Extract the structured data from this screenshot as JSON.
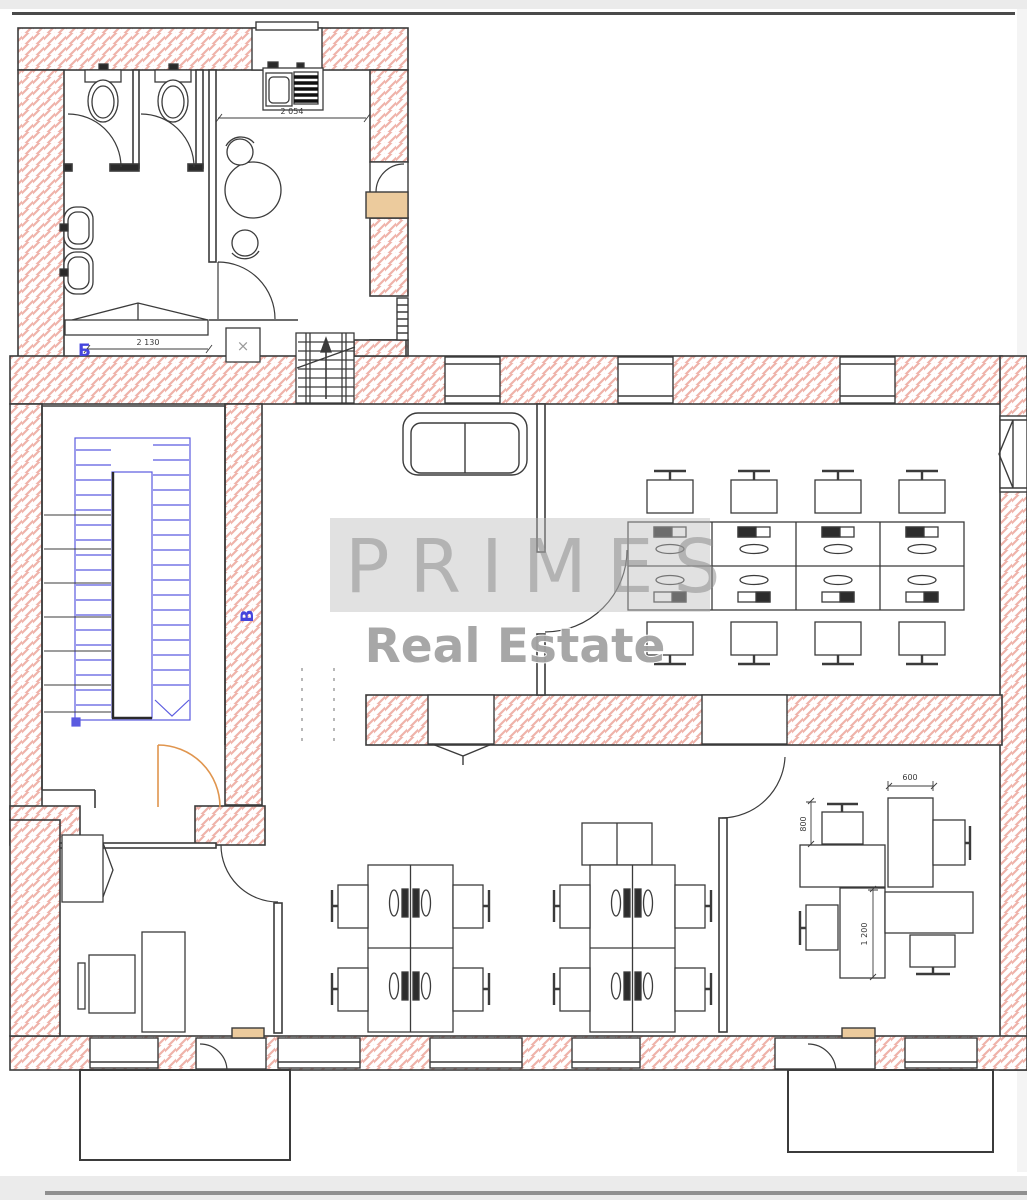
{
  "plan": {
    "kind": "office-floor-plan",
    "section_label_b": "Б",
    "section_label_v": "В",
    "shaft_mark": "×"
  },
  "dimensions": {
    "wc_width": "2 130",
    "kitchen_width": "2 054",
    "pinwheel_desk_top": "600",
    "pinwheel_desk_left": "800",
    "pinwheel_desk_bottom": "1 200"
  },
  "watermark": {
    "brand": "PRIMES",
    "subtitle": "Real Estate"
  },
  "colors": {
    "wall_hatch": "#efb3aa",
    "wall_line": "#3b3b3b",
    "stairs_blue": "#5b5be0",
    "door_orange": "#e0954e",
    "sill_tan": "#eccb9d",
    "watermark_band": "#bdbdbd"
  }
}
